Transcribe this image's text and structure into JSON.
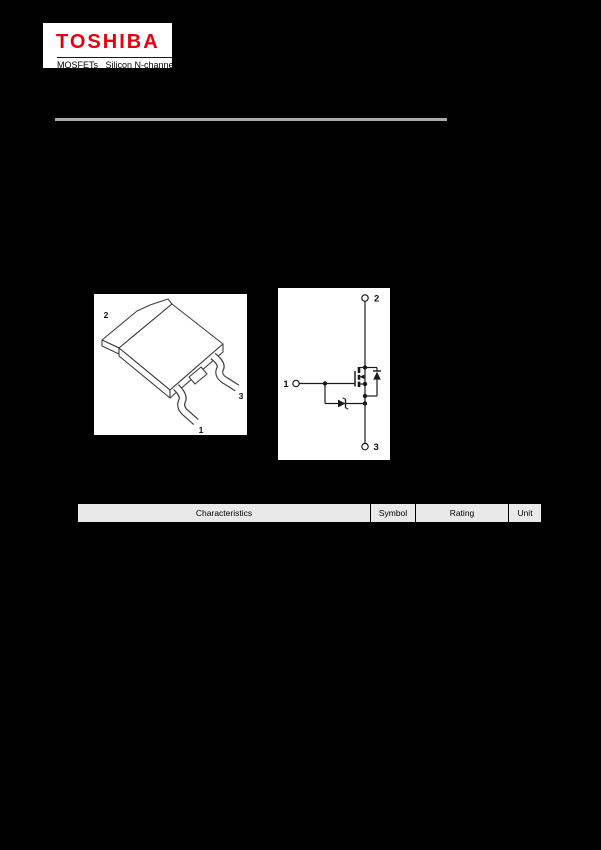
{
  "page": {
    "background": "#000000"
  },
  "logo": {
    "brand": "TOSHIBA",
    "brand_color": "#e60012",
    "subtitle": "MOSFETs   Silicon N-channel"
  },
  "rule_color": "#ababab",
  "figures": {
    "background": "#ffffff",
    "line_color": "#3f3f3f",
    "package": {
      "description": "isometric surface-mount package drawing (tab + two gull-wing leads + cut center lead)",
      "labels": {
        "pin2": "2",
        "pin3": "3",
        "pin1": "1"
      }
    },
    "circuit": {
      "description": "internal schematic: N-channel MOSFET with body diode and gate-protection zener",
      "labels": {
        "terminal2": "2",
        "terminal1": "1",
        "terminal3": "3"
      }
    }
  },
  "table": {
    "header_bg": "#e9e9e9",
    "headers": [
      "Characteristics",
      "Symbol",
      "Rating",
      "Unit"
    ]
  }
}
